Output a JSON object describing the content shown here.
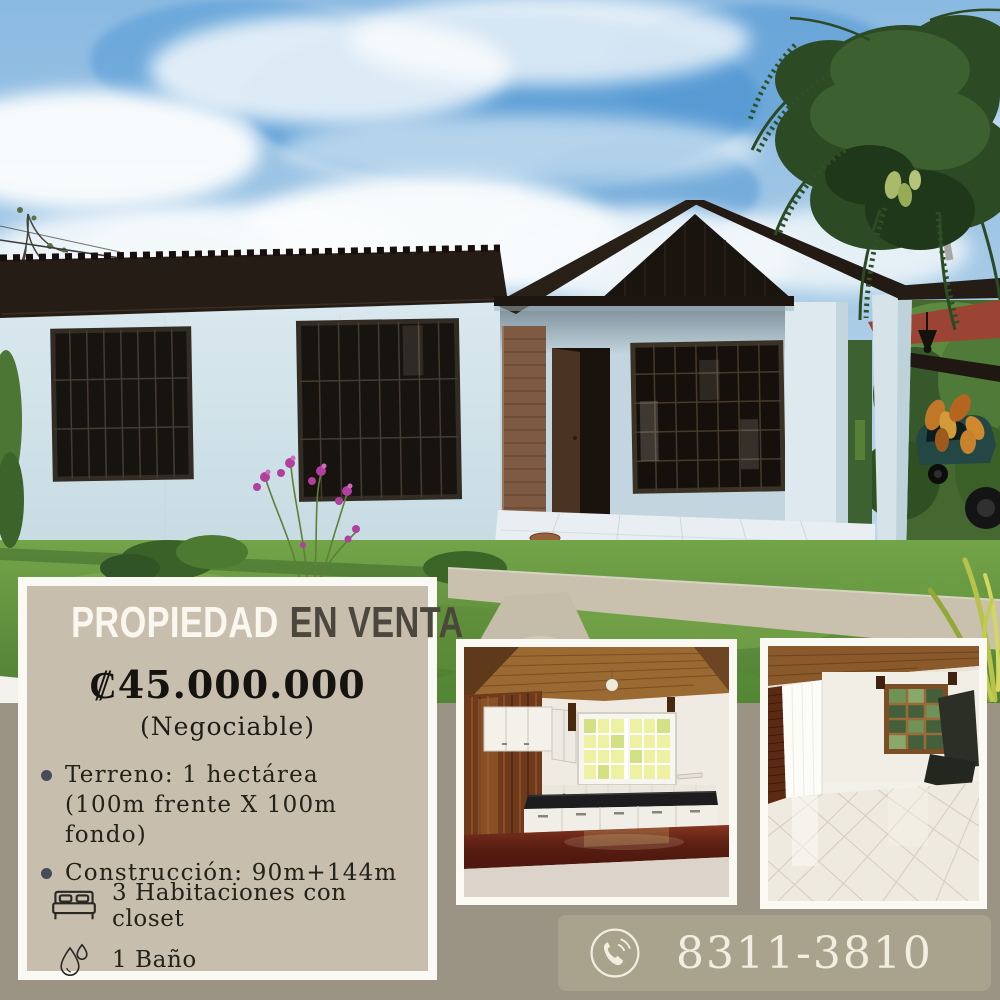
{
  "poster": {
    "title_part1": "PROPIEDAD",
    "title_part2": "EN VENTA",
    "price": "₡45.000.000",
    "price_note": "(Negociable)",
    "details": [
      {
        "line1": "Terreno: 1 hectárea",
        "line2": "(100m frente X 100m fondo)"
      },
      {
        "line1": "Construcción: 90m+144m",
        "line2": ""
      }
    ],
    "features": [
      {
        "icon": "bed-icon",
        "label": "3 Habitaciones con closet"
      },
      {
        "icon": "water-drop-icon",
        "label": "1 Baño"
      }
    ],
    "phone": "8311-3810",
    "photos": {
      "main": "exterior-house-photo",
      "left": "kitchen-photo",
      "right": "living-room-photo"
    },
    "colors": {
      "page_bg": "#9b9383",
      "card_bg": "#c7beae",
      "card_border": "#fbf9f4",
      "phone_bar_bg": "#a9a28c",
      "title_light": "#faf7ef",
      "title_dark": "#4b473c",
      "price_text": "#14130f",
      "body_text": "#232218",
      "phone_text": "#f2eedf"
    }
  }
}
